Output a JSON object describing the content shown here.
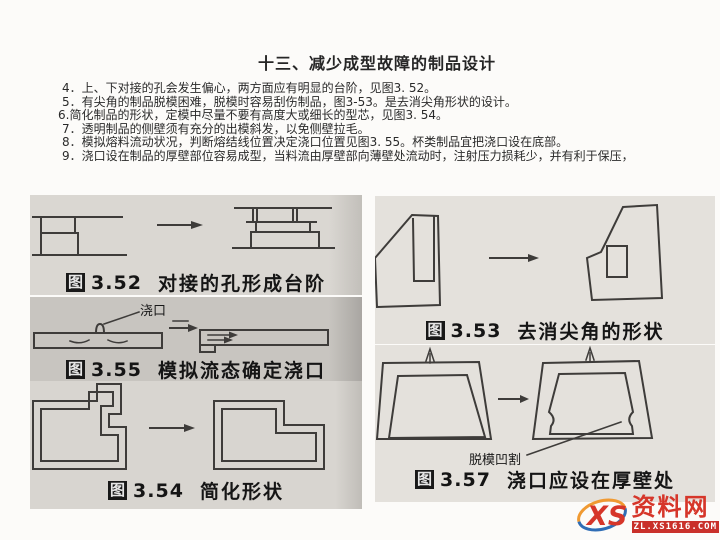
{
  "page": {
    "title": "十三、减少成型故障的制品设计",
    "body_lines": [
      "4．上、下对接的孔会发生偏心，两方面应有明显的台阶，见图3. 52。",
      "5．有尖角的制品脱模困难，脱模时容易刮伤制品，图3-53。是去消尖角形状的设计。",
      "6.简化制品的形状，定模中尽量不要有高度大或细长的型芯，见图3. 54。",
      "7．透明制品的侧壁须有充分的出模斜发，以免侧壁拉毛。",
      "8．模拟熔料流动状况，判断熔结线位置决定浇口位置见图3. 55。杯类制品宜把浇口设在底部。",
      "9．浇口设在制品的厚壁部位容易成型，当料流由厚壁部向薄壁处流动时，注射压力损耗少，并有利于保压，"
    ]
  },
  "figures": {
    "fig352": {
      "tag": "图",
      "number": "3.52",
      "caption": "对接的孔形成台阶"
    },
    "fig355": {
      "tag": "图",
      "number": "3.55",
      "caption": "模拟流态确定浇口",
      "annotation": "浇口"
    },
    "fig354": {
      "tag": "图",
      "number": "3.54",
      "caption": "简化形状"
    },
    "fig353": {
      "tag": "图",
      "number": "3.53",
      "caption": "去消尖角的形状"
    },
    "fig357": {
      "tag": "图",
      "number": "3.57",
      "caption": "浇口应设在厚壁处",
      "annotation": "脱模凹割"
    }
  },
  "watermark": {
    "logo_text": "XS",
    "site_name": "资料网",
    "site_url": "ZL.XS1616.COM",
    "colors": {
      "red": "#d6362a",
      "banner_red": "#c9302a",
      "blue": "#2f6db5",
      "orange": "#f09a32"
    }
  }
}
